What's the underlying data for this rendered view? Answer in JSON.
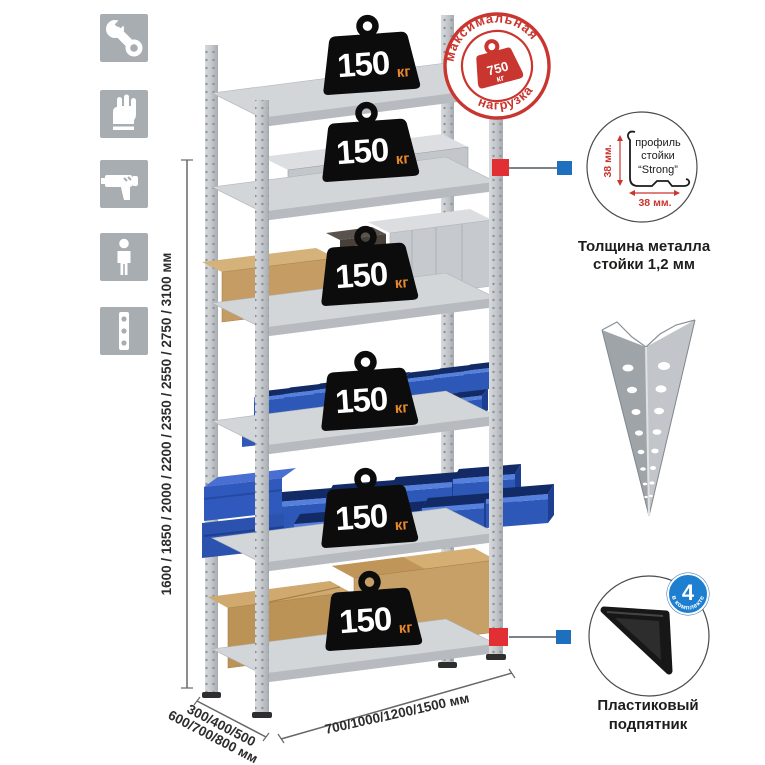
{
  "badges": {
    "value": "150",
    "unit": "кг"
  },
  "stamp": {
    "arc_top": "максимальная",
    "arc_bottom": "нагрузка",
    "value": "750",
    "unit": "кг"
  },
  "dimensions": {
    "height": "1600 / 1850 / 2000 / 2200 / 2350 / 2550 / 2750 / 3100 мм",
    "depth_line1": "300/400/500",
    "depth_line2": "600/700/800 мм",
    "width": "700/1000/1200/1500 мм"
  },
  "profile_detail": {
    "dim_vertical": "38 мм.",
    "dim_horizontal": "38 мм.",
    "label_line1": "профиль",
    "label_line2": "стойки",
    "label_line3": "“Strong”",
    "caption_line1": "Толщина металла",
    "caption_line2": "стойки 1,2 мм"
  },
  "foot_detail": {
    "badge_value": "4",
    "badge_arc": "в комплекте",
    "caption_line1": "Пластиковый",
    "caption_line2": "подпятник"
  },
  "sidebar": {
    "icons": [
      "wrench",
      "gloves",
      "drill",
      "person",
      "level"
    ]
  },
  "colors": {
    "stamp_red": "#c9362f",
    "connector_red": "#e12f33",
    "connector_blue": "#1f6fbf",
    "badge_orange": "#e8872b",
    "bin_blue": "#2d58b8",
    "metal_gray": "#c6c9cd",
    "icon_gray": "#a8adb2"
  }
}
